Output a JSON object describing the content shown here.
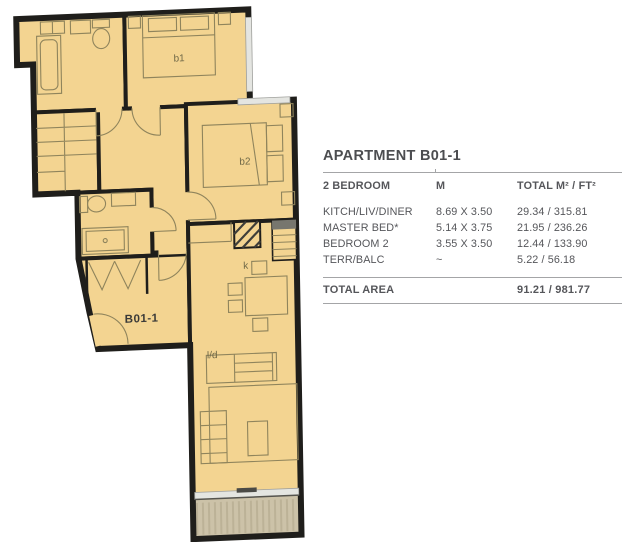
{
  "panel": {
    "title": "APARTMENT B01-1",
    "columns": [
      "2 BEDROOM",
      "M",
      "TOTAL M² / FT²"
    ],
    "rows": [
      {
        "name": "KITCH/LIV/DINER",
        "dims": "8.69 X 3.50",
        "total": "29.34 / 315.81"
      },
      {
        "name": "MASTER BED*",
        "dims": "5.14 X 3.75",
        "total": "21.95 / 236.26"
      },
      {
        "name": "BEDROOM 2",
        "dims": "3.55 X 3.50",
        "total": "12.44 / 133.90"
      },
      {
        "name": "TERR/BALC",
        "dims": "~",
        "total": "5.22 / 56.18"
      }
    ],
    "total_label": "TOTAL AREA",
    "total_value": "91.21 / 981.77"
  },
  "floorplan": {
    "apartment_label": "B01-1",
    "rooms": {
      "bedroom1": "b1",
      "bedroom2": "b2",
      "kitchen": "k",
      "living_dining": "l/d"
    },
    "colors": {
      "floor": "#f3d491",
      "wall": "#1f1e1b",
      "furniture_line": "#8f845c",
      "room_label": "#6f6847",
      "terrace_fill": "#ccc2a8",
      "terrace_stripe": "#bcb297",
      "window": "#e4e5e1",
      "text_gray": "#55565a"
    }
  }
}
